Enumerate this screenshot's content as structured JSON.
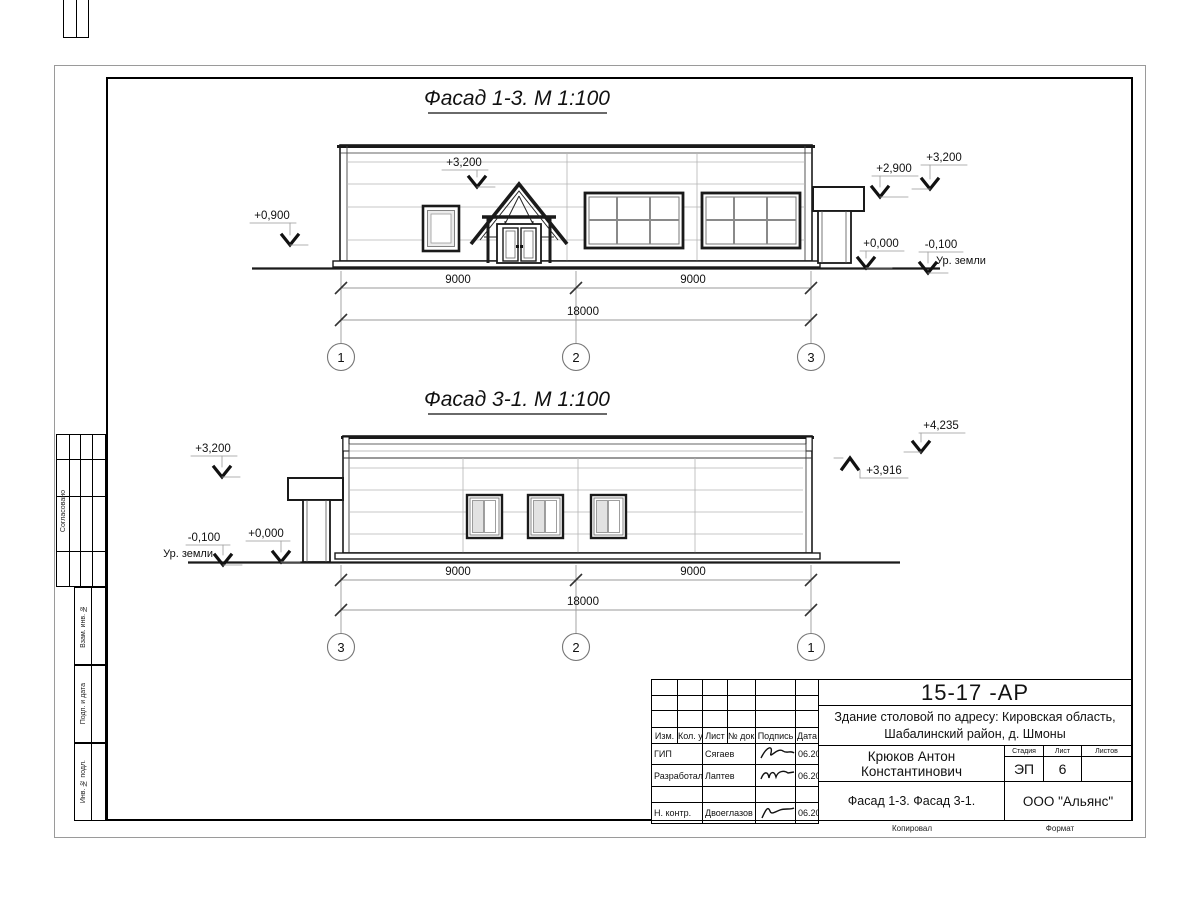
{
  "titles": {
    "facade13": "Фасад 1-3.  М 1:100",
    "facade31": "Фасад 3-1.  М 1:100"
  },
  "facade13": {
    "marks": {
      "m0900": "+0,900",
      "m3200_roof": "+3,200",
      "m2900": "+2,900",
      "m3200_right": "+3,200",
      "m0000": "+0,000",
      "m0100": "-0,100",
      "ground": "Ур. земли"
    },
    "dims": {
      "left": "9000",
      "right": "9000",
      "total": "18000"
    },
    "axes": [
      "1",
      "2",
      "3"
    ]
  },
  "facade31": {
    "marks": {
      "m3200": "+3,200",
      "m0100": "-0,100",
      "ground": "Ур. земли",
      "m0000": "+0,000",
      "m4235": "+4,235",
      "m3916": "+3,916"
    },
    "dims": {
      "left": "9000",
      "right": "9000",
      "total": "18000"
    },
    "axes": [
      "3",
      "2",
      "1"
    ]
  },
  "sidebar": {
    "agreed": "Согласовано",
    "vzam": "Взам. инв. №",
    "podp": "Подп. и дата",
    "inv": "Инв. № подл."
  },
  "titleblock": {
    "doc_number": "15-17 -АР",
    "project_line1": "Здание столовой по адресу: Кировская область,",
    "project_line2": "Шабалинский район, д. Шмоны",
    "cols": {
      "izm": "Изм.",
      "kol": "Кол. уч.",
      "list": "Лист",
      "doc": "№ док.",
      "sign": "Подпись",
      "date": "Дата"
    },
    "rows": [
      {
        "role": "ГИП",
        "name": "Сягаев",
        "date": "06.2017"
      },
      {
        "role": "Разработал",
        "name": "Лаптев",
        "date": "06.2017"
      },
      {
        "role": "Н. контр.",
        "name": "Двоеглазов",
        "date": "06.2017"
      }
    ],
    "chief": "Крюков Антон Константинович",
    "stage_label": "Стадия",
    "sheet_label": "Лист",
    "sheets_label": "Листов",
    "stage": "ЭП",
    "sheet_no": "6",
    "sheets_no": "",
    "drawing_title": "Фасад 1-3. Фасад 3-1.",
    "company": "ООО \"Альянс\"",
    "copied": "Копировал",
    "format": "Формат"
  }
}
